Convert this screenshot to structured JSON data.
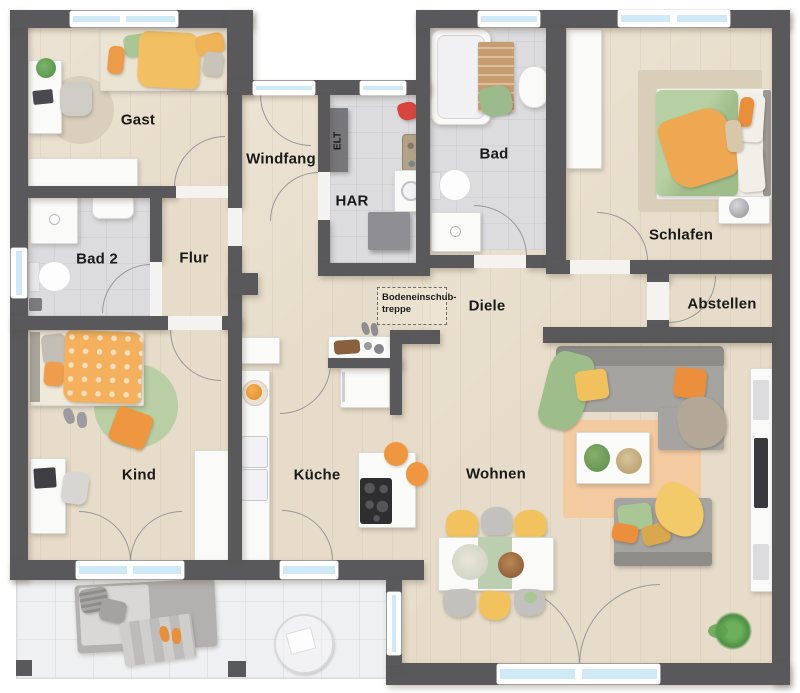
{
  "colors": {
    "wall": "#59595c",
    "wood_floor": "#e7dcc9",
    "tile_floor": "#dcdcdf",
    "terrace_floor": "#eff0f2",
    "window_glass": "#cfe9f7",
    "accent_orange": "#ee9440",
    "accent_yellow": "#f2c15e",
    "accent_green": "#a9c795",
    "sofa_gray": "#a6a4a0"
  },
  "rooms": {
    "gast": "Gast",
    "windfang": "Windfang",
    "elt": "ELT",
    "har": "HAR",
    "bad": "Bad",
    "schlafen": "Schlafen",
    "bad2": "Bad 2",
    "flur": "Flur",
    "diele": "Diele",
    "abstellen": "Abstellen",
    "kind": "Kind",
    "kueche": "Küche",
    "wohnen": "Wohnen"
  },
  "annotations": {
    "attic_stairs_line1": "Bodeneinschub-",
    "attic_stairs_line2": "treppe"
  }
}
